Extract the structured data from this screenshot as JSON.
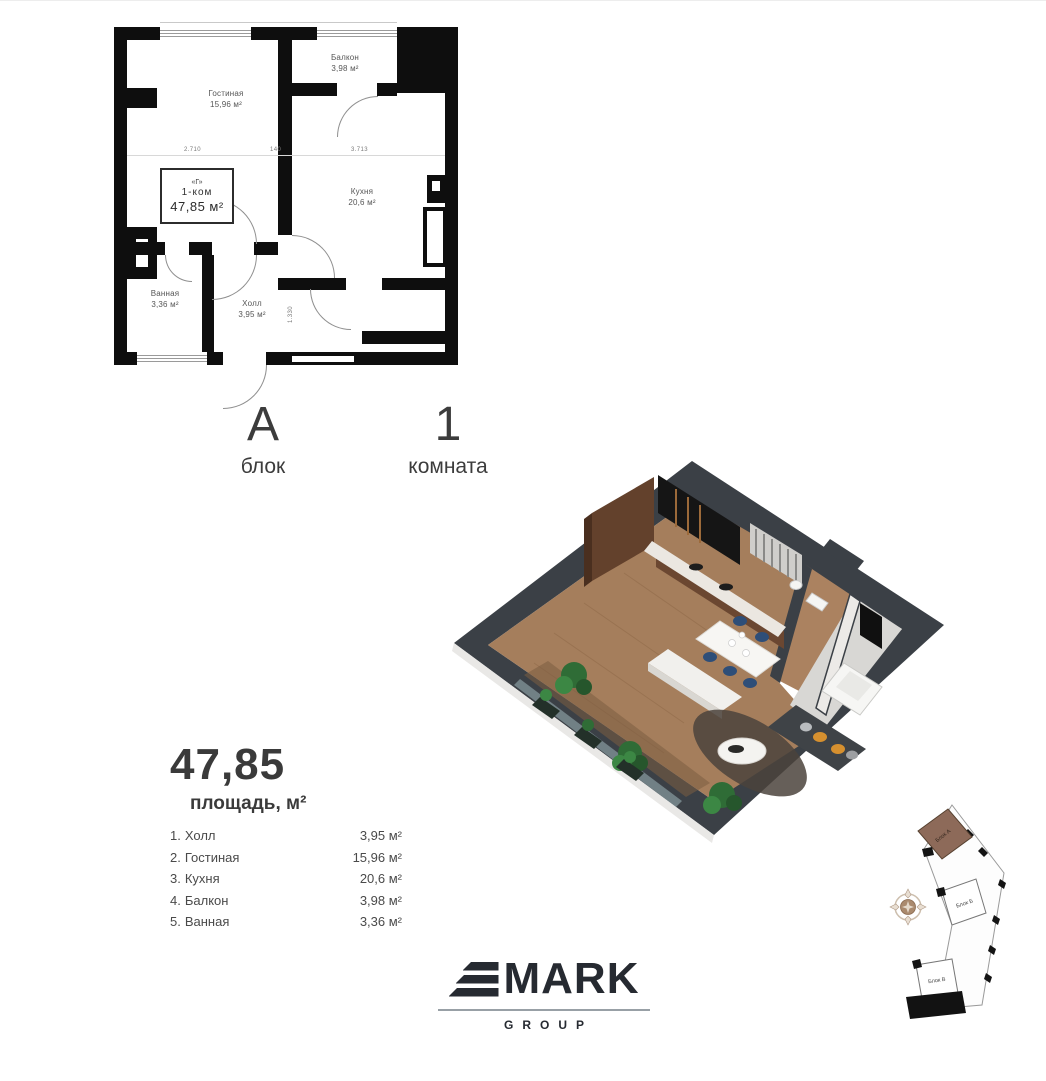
{
  "floorplan": {
    "info_box": {
      "code": "«Г»",
      "type": "1-ком",
      "area": "47,85 м²"
    },
    "rooms": [
      {
        "name": "Гостиная",
        "area": "15,96 м²"
      },
      {
        "name": "Балкон",
        "area": "3,98 м²"
      },
      {
        "name": "Кухня",
        "area": "20,6 м²"
      },
      {
        "name": "Ванная",
        "area": "3,36 м²"
      },
      {
        "name": "Холл",
        "area": "3,95 м²"
      }
    ],
    "dimensions": {
      "top_left": "2.710",
      "top_mid": "140",
      "top_right": "3.713",
      "vertical": "1.330"
    }
  },
  "block_info": {
    "block_letter": "А",
    "block_caption": "блок",
    "room_count": "1",
    "room_caption": "комната"
  },
  "summary": {
    "total": "47,85",
    "caption": "площадь, м²",
    "items": [
      {
        "num": "1.",
        "name": "Холл",
        "area": "3,95 м²"
      },
      {
        "num": "2.",
        "name": "Гостиная",
        "area": "15,96 м²"
      },
      {
        "num": "3.",
        "name": "Кухня",
        "area": "20,6 м²"
      },
      {
        "num": "4.",
        "name": "Балкон",
        "area": "3,98 м²"
      },
      {
        "num": "5.",
        "name": "Ванная",
        "area": "3,36 м²"
      }
    ]
  },
  "logo": {
    "mark": "MARK",
    "group": "GROUP"
  },
  "siteplan": {
    "blocks": [
      {
        "label": "Блок А",
        "highlighted": true
      },
      {
        "label": "Блок Б",
        "highlighted": false
      },
      {
        "label": "Блок В",
        "highlighted": false
      }
    ]
  },
  "colors": {
    "wall": "#0e0e0e",
    "charcoal_3d": "#3b4046",
    "wood_floor": "#a57e5c",
    "site_block_highlight": "#8d6a59",
    "chair_navy": "#2e4e78",
    "cushion_orange": "#d6902f"
  }
}
